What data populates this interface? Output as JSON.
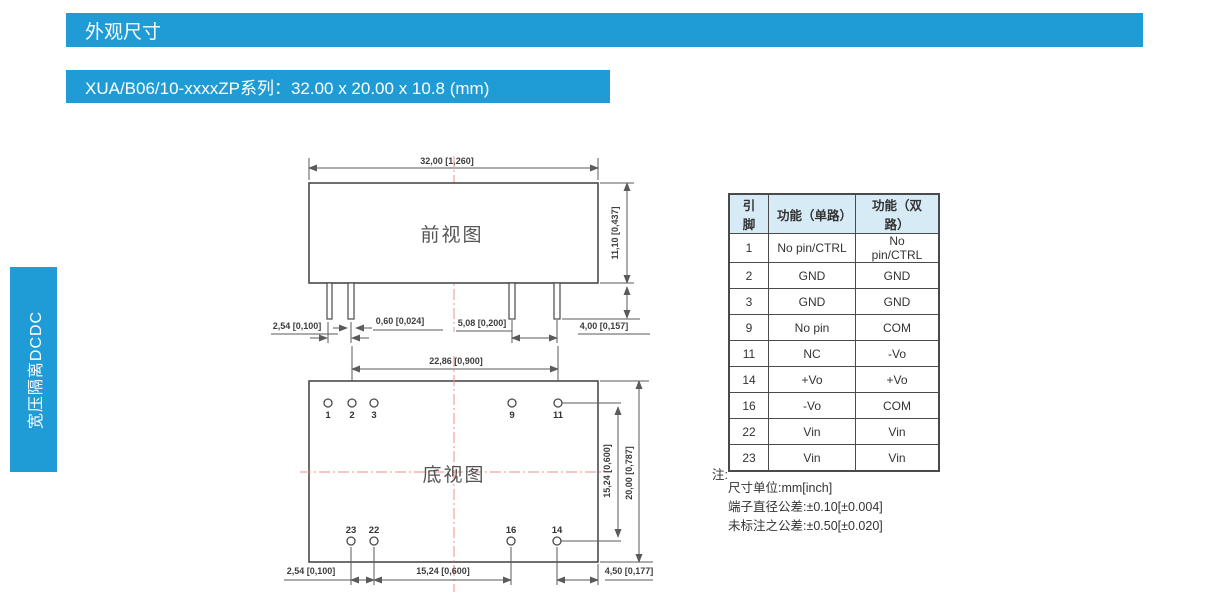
{
  "page": {
    "section_title": "外观尺寸",
    "series_title": "XUA/B06/10-xxxxZP系列：32.00 x 20.00 x 10.8 (mm)",
    "sidebar_label": "宽压隔离DCDC"
  },
  "front_view": {
    "label": "前视图",
    "dims": {
      "width": "32,00 [1,260]",
      "height": "11,10 [0,437]",
      "pin_pitch": "2,54 [0,100]",
      "pin_width": "0,60 [0,024]",
      "pin_spacing_right": "5,08 [0,200]",
      "pin_length": "4,00 [0,157]"
    }
  },
  "bottom_view": {
    "label": "底视图",
    "dims": {
      "pin_span": "22,86 [0,900]",
      "row_span": "15,24 [0,600]",
      "depth": "20,00 [0,787]",
      "pin_pitch": "2,54 [0,100]",
      "pin_group": "15,24 [0,600]",
      "edge_offset": "4,50 [0,177]"
    },
    "top_pins": [
      "1",
      "2",
      "3",
      "9",
      "11"
    ],
    "bottom_pins": [
      "23",
      "22",
      "16",
      "14"
    ]
  },
  "pin_table": {
    "headers": [
      "引脚",
      "功能（单路）",
      "功能（双路）"
    ],
    "rows": [
      [
        "1",
        "No pin/CTRL",
        "No pin/CTRL"
      ],
      [
        "2",
        "GND",
        "GND"
      ],
      [
        "3",
        "GND",
        "GND"
      ],
      [
        "9",
        "No pin",
        "COM"
      ],
      [
        "11",
        "NC",
        "-Vo"
      ],
      [
        "14",
        "+Vo",
        "+Vo"
      ],
      [
        "16",
        "-Vo",
        "COM"
      ],
      [
        "22",
        "Vin",
        "Vin"
      ],
      [
        "23",
        "Vin",
        "Vin"
      ]
    ]
  },
  "notes": {
    "label": "注:",
    "lines": [
      "尺寸单位:mm[inch]",
      "端子直径公差:±0.10[±0.004]",
      "未标注之公差:±0.50[±0.020]"
    ]
  },
  "colors": {
    "accent_blue": "#1F9BD5",
    "table_header_bg": "#D7EBF7",
    "drawing_gray": "#4A4A4A",
    "centerline_red": "#EF8E8E"
  }
}
